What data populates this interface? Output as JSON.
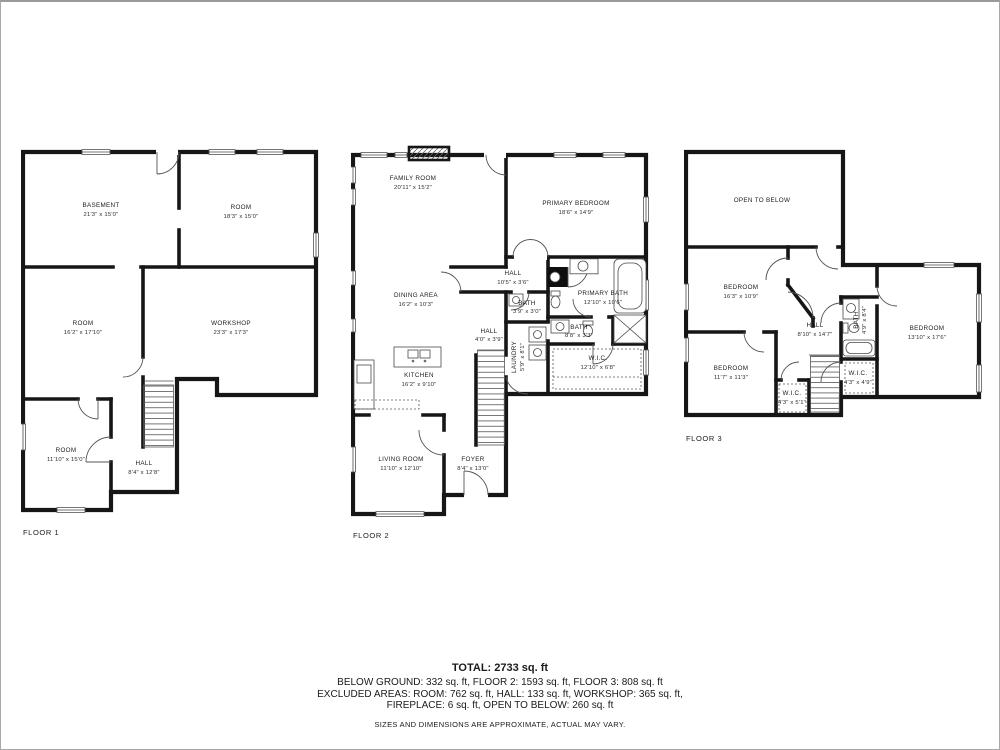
{
  "page": {
    "background": "#ffffff",
    "border_color": "#a8a8a8",
    "wall_color": "#161616",
    "text_color": "#1a1a1a"
  },
  "floors": [
    {
      "label": "FLOOR 1",
      "rooms": [
        {
          "name": "BASEMENT",
          "dims": "21'3\" x 15'0\""
        },
        {
          "name": "ROOM",
          "dims": "18'3\" x 15'0\""
        },
        {
          "name": "ROOM",
          "dims": "16'2\" x 17'10\""
        },
        {
          "name": "WORKSHOP",
          "dims": "23'3\" x 17'3\""
        },
        {
          "name": "ROOM",
          "dims": "11'10\" x 15'0\""
        },
        {
          "name": "HALL",
          "dims": "8'4\" x 12'8\""
        }
      ]
    },
    {
      "label": "FLOOR 2",
      "rooms": [
        {
          "name": "FAMILY ROOM",
          "dims": "20'11\" x 15'2\""
        },
        {
          "name": "PRIMARY BEDROOM",
          "dims": "18'6\" x 14'9\""
        },
        {
          "name": "HALL",
          "dims": "10'5\" x 3'6\""
        },
        {
          "name": "DINING AREA",
          "dims": "16'2\" x 10'3\""
        },
        {
          "name": "BATH",
          "dims": "3'9\" x 3'0\""
        },
        {
          "name": "PRIMARY BATH",
          "dims": "12'10\" x 10'6\""
        },
        {
          "name": "HALL",
          "dims": "4'0\" x 3'9\""
        },
        {
          "name": "LAUNDRY",
          "dims": "5'9\" x 8'1\""
        },
        {
          "name": "BATH",
          "dims": "8'8\" x 3'3\""
        },
        {
          "name": "W.I.C.",
          "dims": "12'10\" x 6'8\""
        },
        {
          "name": "KITCHEN",
          "dims": "16'2\" x 9'10\""
        },
        {
          "name": "LIVING ROOM",
          "dims": "11'10\" x 12'10\""
        },
        {
          "name": "FOYER",
          "dims": "8'4\" x 13'0\""
        }
      ]
    },
    {
      "label": "FLOOR 3",
      "rooms": [
        {
          "name": "OPEN TO BELOW",
          "dims": ""
        },
        {
          "name": "BEDROOM",
          "dims": "16'3\" x 10'9\""
        },
        {
          "name": "HALL",
          "dims": "8'10\" x 14'7\""
        },
        {
          "name": "BATH",
          "dims": "4'9\" x 8'4\""
        },
        {
          "name": "BEDROOM",
          "dims": "13'10\" x 17'6\""
        },
        {
          "name": "BEDROOM",
          "dims": "11'7\" x 11'3\""
        },
        {
          "name": "W.I.C.",
          "dims": "4'3\" x 5'1\""
        },
        {
          "name": "W.I.C.",
          "dims": "4'3\" x 4'9\""
        }
      ]
    }
  ],
  "summary": {
    "total": "TOTAL: 2733 sq. ft",
    "line1": "BELOW GROUND: 332 sq. ft, FLOOR 2: 1593 sq. ft, FLOOR 3: 808 sq. ft",
    "line2": "EXCLUDED AREAS: ROOM: 762 sq. ft, HALL: 133 sq. ft, WORKSHOP: 365 sq. ft,",
    "line3": "FIREPLACE: 6 sq. ft, OPEN TO BELOW: 260 sq. ft",
    "disclaimer": "SIZES AND DIMENSIONS ARE APPROXIMATE, ACTUAL MAY VARY."
  }
}
